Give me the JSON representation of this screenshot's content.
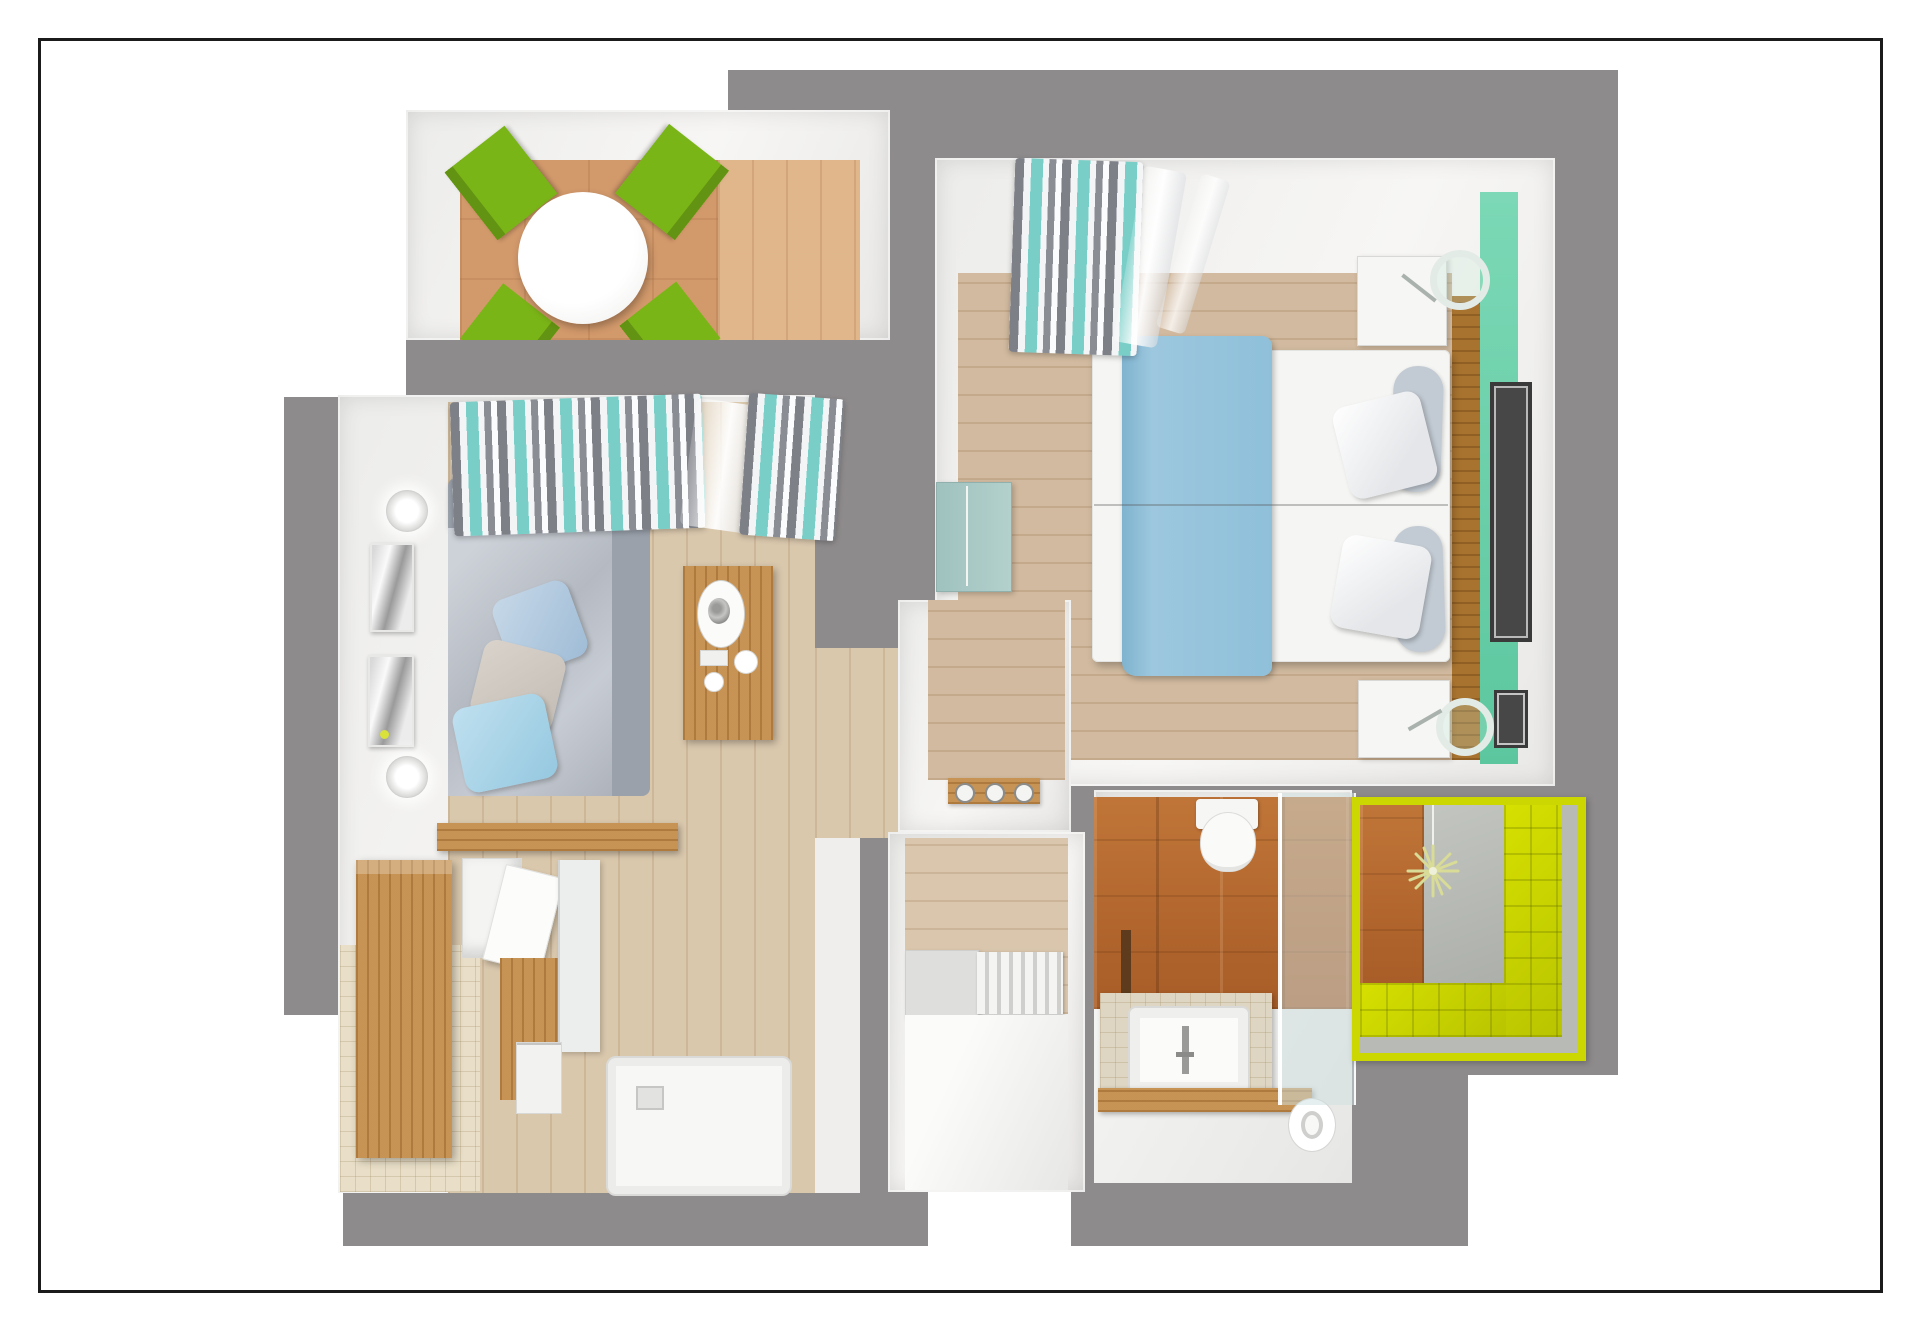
{
  "scene": {
    "description": "3D top-down rendered floor plan of a one-bedroom apartment with balcony",
    "visible_text": "none",
    "palette": {
      "wallGray": "#8e8b8c",
      "wallWhite": "#f1f0ee",
      "pageWhite": "#ffffff",
      "frameBlack": "#1b1b1b",
      "floorLiving": "#d8c5a9",
      "floorBedroom": "#cfb69a",
      "balconyTerracotta": "#d2996b",
      "balconyWood": "#dfb285",
      "kitchenTile": "#e9dfc8",
      "bathTile": "#b76a33",
      "lime": "#ccd600",
      "teal": "#6ed0ac",
      "bedBlue": "#93c0da",
      "sofaGray": "#bfc4cc",
      "chairGreen": "#7ab517",
      "wood": "#c18a4a",
      "glass": "#ccdcdd"
    },
    "rooms": [
      {
        "id": "balcony",
        "position": "top-left",
        "furniture": [
          "round-white-dining-table",
          "green-chair-1",
          "green-chair-2",
          "green-chair-3",
          "green-chair-4"
        ],
        "floors": [
          "terracotta-tile",
          "wood-deck"
        ]
      },
      {
        "id": "living-room",
        "position": "left",
        "furniture": [
          "gray-sofa",
          "sofa-pillow-blue",
          "sofa-pillow-beige",
          "sofa-pillow-lightblue",
          "wall-sconce-1",
          "wall-sconce-2",
          "wall-mirror-1",
          "wall-mirror-2",
          "striped-curtains",
          "wall-console-with-plate",
          "wood-console-bar",
          "tall-kitchen-cabinet",
          "open-kitchen-cabinet",
          "base-cabinet",
          "fridge-panel",
          "drawer-unit",
          "shower-tray"
        ],
        "floors": [
          "light-wood-plank",
          "beige-tile"
        ]
      },
      {
        "id": "bedroom",
        "position": "top-right",
        "furniture": [
          "double-bed-blue-blanket",
          "pillow-1",
          "pillow-2",
          "bolster-1",
          "bolster-2",
          "nightstand-1",
          "nightstand-2",
          "table-lamp-1",
          "table-lamp-2",
          "teal-sideboard",
          "striped-curtain",
          "headboard-bench",
          "teal-accent-wall",
          "picture-frame-large",
          "picture-frame-small"
        ],
        "floors": [
          "light-wood-plank"
        ]
      },
      {
        "id": "kitchen-niche",
        "position": "center",
        "furniture": [
          "cooktop-3-burners"
        ],
        "floors": [
          "light-wood-plank"
        ]
      },
      {
        "id": "hallway",
        "position": "bottom-center",
        "furniture": [
          "staircase-7-steps",
          "stair-landing"
        ],
        "floors": [
          "light-wood-plank",
          "white-screed"
        ]
      },
      {
        "id": "bathroom",
        "position": "bottom-right",
        "furniture": [
          "toilet",
          "vanity-counter",
          "white-sink",
          "faucet",
          "wood-shelf",
          "towel-roll",
          "glass-partition",
          "shower-cabin-lime",
          "rain-shower-head"
        ],
        "floors": [
          "white-screed",
          "gray-shower-floor"
        ],
        "walls": [
          "terracotta-tile",
          "lime-tile"
        ]
      }
    ]
  }
}
